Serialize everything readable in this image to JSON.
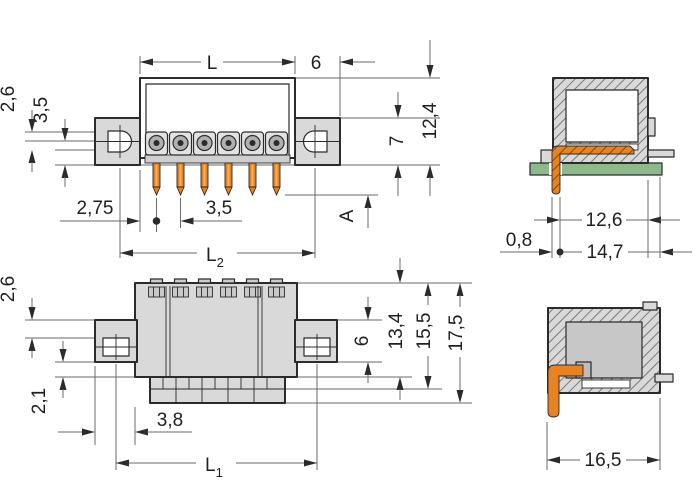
{
  "colors": {
    "outline": "#2b2b2b",
    "body_fill": "#d9d9d9",
    "pin_orange": "#e8831f",
    "pcb_green": "#8eba8b",
    "dim_line": "#6a6a6a",
    "text": "#1f1f1f"
  },
  "views": {
    "front": {
      "pole_count_shown": 6,
      "dims": {
        "L": "L",
        "six": "6",
        "two_six": "2,6",
        "three_five": "3,5",
        "two_seven_five": "2,75",
        "pitch": "3,5",
        "A": "A",
        "seven": "7",
        "twelve_four": "12,4",
        "L2_base": "L",
        "L2_sub": "2"
      }
    },
    "side_mounted": {
      "dims": {
        "zero_eight": "0,8",
        "twelve_six": "12,6",
        "fourteen_seven": "14,7"
      }
    },
    "plan": {
      "dims": {
        "two_six": "2,6",
        "two_one": "2,1",
        "three_eight": "3,8",
        "six": "6",
        "thirteen_four": "13,4",
        "fifteen_five": "15,5",
        "seventeen_five": "17,5",
        "L1_base": "L",
        "L1_sub": "1"
      }
    },
    "side_detail": {
      "dims": {
        "sixteen_five": "16,5"
      }
    }
  }
}
